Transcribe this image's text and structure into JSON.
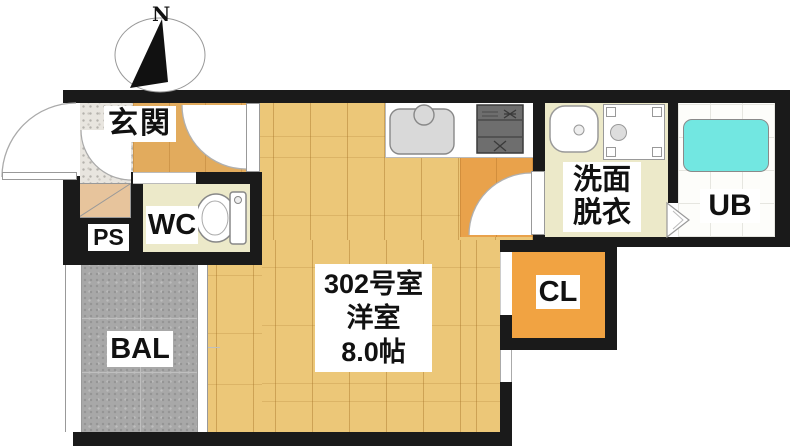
{
  "title": "Japanese apartment floor plan",
  "compass": {
    "label": "N"
  },
  "rooms": {
    "entrance": {
      "label": "玄関"
    },
    "wc": {
      "label": "WC"
    },
    "pipe_space": {
      "label": "PS"
    },
    "balcony": {
      "label": "BAL"
    },
    "main_room": {
      "number": "302号室",
      "type": "洋室",
      "size": "8.0帖"
    },
    "washroom": {
      "label_line1": "洗面",
      "label_line2": "脱衣"
    },
    "closet": {
      "label": "CL"
    },
    "unit_bath": {
      "label": "UB"
    }
  },
  "colors": {
    "wall": "#1a1a1a",
    "wood": "#ecc778",
    "hallway": "#e2ab5d",
    "kitchen_floor": "#e9a24b",
    "closet": "#f1a342",
    "cream": "#ece9c9",
    "balcony": "#a8a8a8",
    "bathtub": "#72e7e1",
    "entrance_tile": "#e8e5df",
    "cabinet_tan": "#e7c49c",
    "stove": "#6e6e6e",
    "fixture_outline": "#8a8a8a"
  }
}
